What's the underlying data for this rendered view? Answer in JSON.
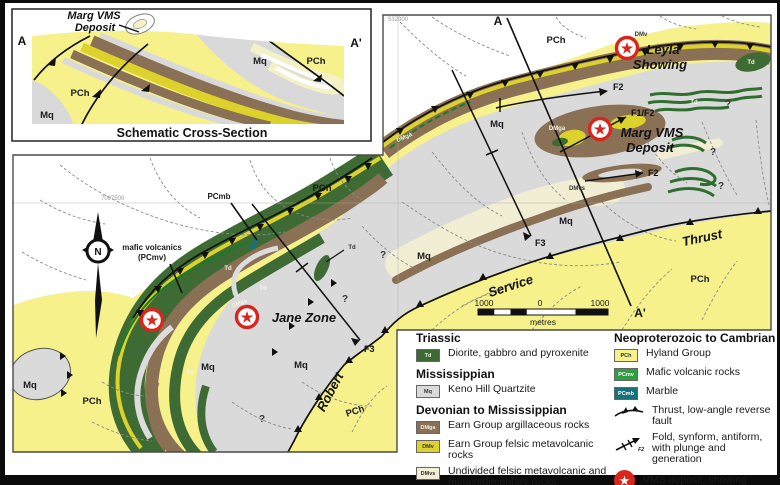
{
  "icons": {
    "star": "★"
  },
  "colors": {
    "pch": "#f6f18b",
    "dmv": "#ddd22b",
    "dmvs": "#f1eed3",
    "dmga": "#8a7055",
    "td": "#3e6b33",
    "pcmv": "#2f9e41",
    "pcmb": "#15717a",
    "mq": "#dadada",
    "deposit_red": "#d8261d"
  },
  "cross_section": {
    "title": "Schematic Cross-Section",
    "label_a": "A",
    "label_a_prime": "A'",
    "deposit_line1": "Marg VMS",
    "deposit_line2": "Deposit",
    "units": {
      "pch": "PCh",
      "mq": "Mq"
    }
  },
  "map": {
    "grid": {
      "northing": "7097500",
      "easting": "532000"
    },
    "section_line": {
      "start": "A",
      "end": "A'"
    },
    "compass": {
      "n": "N"
    },
    "deposits": {
      "leyla_line1": "Leyla",
      "leyla_line2": "Showing",
      "marg_line1": "Marg VMS",
      "marg_line2": "Deposit",
      "jane": "Jane Zone"
    },
    "faults": {
      "thrust": "Thrust"
    },
    "creeks": {
      "service": "Service",
      "robert": "Robert"
    },
    "folds": {
      "f2_north": "F2",
      "f1f2": "F1/F2",
      "f2_marg": "F2",
      "f3_center": "F3",
      "f3_jane": "F3"
    },
    "callouts": {
      "pcmb": "PCmb",
      "mafic_line1": "mafic volcanics",
      "mafic_line2": "(PCmv)"
    },
    "units": {
      "pch": "PCh",
      "mq": "Mq",
      "td": "Td",
      "dmga": "DMga",
      "dmv": "DMv",
      "dmvs": "DMvs"
    },
    "question_mark": "?",
    "scale_bar": {
      "left": "1000",
      "zero": "0",
      "right": "1000",
      "unit": "metres"
    }
  },
  "legend": {
    "groups": [
      {
        "header": "Triassic",
        "items": [
          {
            "code": "Td",
            "label": "Diorite, gabbro and pyroxenite"
          }
        ]
      },
      {
        "header": "Mississippian",
        "items": [
          {
            "code": "Mq",
            "label": "Keno Hill Quartzite"
          }
        ]
      },
      {
        "header": "Devonian to Mississippian",
        "items": [
          {
            "code": "DMga",
            "label": "Earn Group argillaceous rocks"
          },
          {
            "code": "DMv",
            "label": "Earn Group felsic metavolcanic rocks"
          },
          {
            "code": "DMvs",
            "label": "Undivided felsic metavolcanic and metasedimentary rocks"
          }
        ]
      },
      {
        "header": "Neoproterozoic to Cambrian",
        "items": [
          {
            "code": "PCh",
            "label": "Hyland Group"
          },
          {
            "code": "PCmv",
            "label": "Mafic volcanic rocks"
          },
          {
            "code": "PCmb",
            "label": "Marble"
          }
        ]
      }
    ],
    "symbols": [
      {
        "label": "Thrust, low-angle reverse fault"
      },
      {
        "label": "Fold, synform, antiform, with plunge and generation",
        "tag": "F2"
      },
      {
        "label": "VMS deposit, showing"
      }
    ]
  }
}
